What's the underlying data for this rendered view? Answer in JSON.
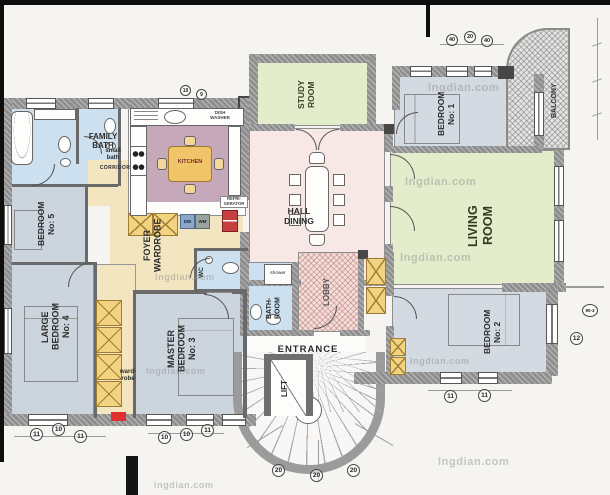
{
  "watermark": {
    "text": "lngdian.com"
  },
  "rooms": {
    "family_bath": "FAMILY\nBATH",
    "small_bath": "small\nbath",
    "corridor": "CORRIDOR",
    "kitchen": "KITCHEN",
    "bedroom5": "BEDROOM\nNo: 5",
    "foyer": "FOYER\nWARDROBE",
    "wardrobe": "ward-\nrobe",
    "bedroom4": "LARGE\nBEDROOM\nNo: 4",
    "master": "MASTER\nBEDROOM\nNo: 3",
    "wc": "WC",
    "bathroom": "BATH-\nROOM",
    "shower": "shower",
    "lobby": "LOBBY",
    "entrance": "ENTRANCE",
    "lift": "LIFT",
    "hall": "HALL\nDINING",
    "study": "STUDY\nROOM",
    "bedroom1": "BEDROOM\nNo: 1",
    "balcony": "BALCONY",
    "living": "LIVING\nROOM",
    "bedroom2": "BEDROOM\nNo: 2"
  },
  "appliances": {
    "dish_washer": "DISH\nWASHER",
    "refrigerator": "REFRI-\nGERATOR",
    "dw": "DW",
    "wm": "WM"
  },
  "dimensions": {
    "bottom_left": [
      "11",
      "10",
      "11"
    ],
    "bottom_mid": [
      "10",
      "10",
      "11"
    ],
    "bedroom2": [
      "11",
      "11"
    ],
    "right": "12",
    "right_edge": "90-3",
    "stairs": [
      "20",
      "20",
      "20"
    ],
    "top_right": [
      "40",
      "20",
      "40"
    ],
    "kitchen_top": [
      "10",
      "9"
    ]
  },
  "colors": {
    "bedroom_fill": "#d3dae2",
    "bath_fill": "#cde0ef",
    "green_fill": "#e3edcb",
    "pink_fill": "#f8e8e5",
    "cream_fill": "#f2e5c0",
    "kitchen_floor": "#c6a8bb",
    "wardrobe_yellow": "#f2d382",
    "highlight_red": "#e03030"
  }
}
